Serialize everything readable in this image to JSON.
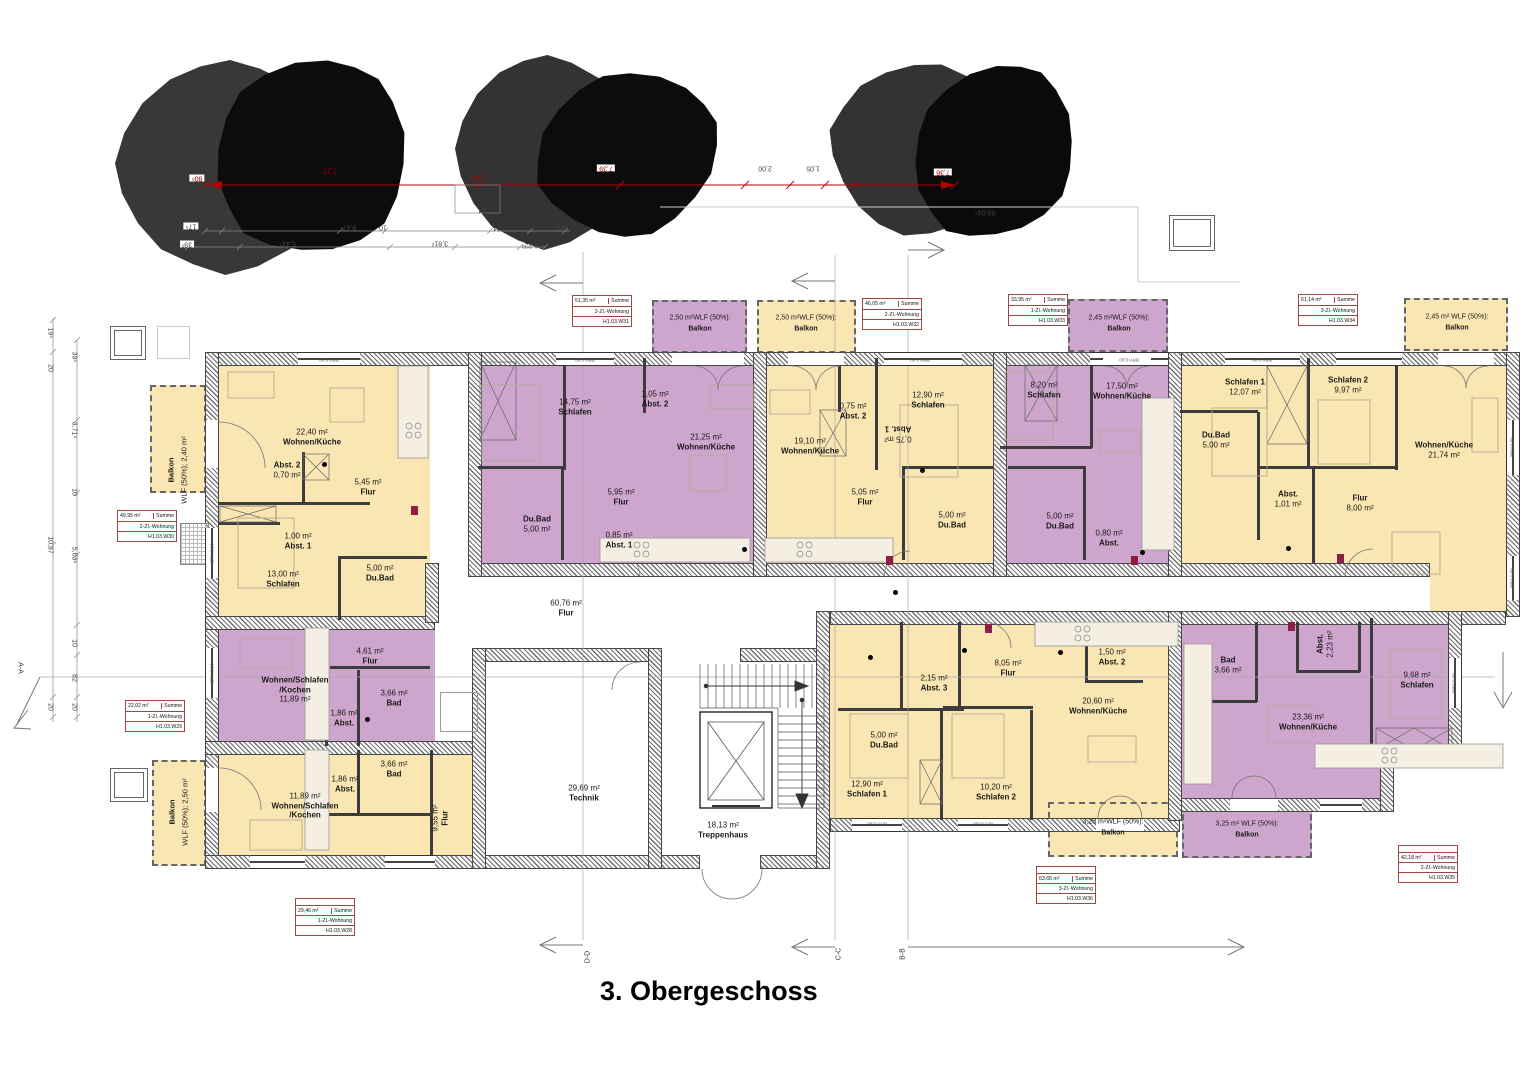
{
  "title": "3. Obergeschoss",
  "labels": {
    "summe": "Summe"
  },
  "window_label": "BRH 0,00",
  "colors": {
    "apartment_yellow": "#FAE6B2",
    "apartment_purple": "#CEA5CC",
    "info_border": "#A04444",
    "dim_red": "#B30000"
  },
  "sections": {
    "aa": "A-A",
    "bb": "B-B",
    "cc": "C-C",
    "dd": "D-D"
  },
  "apartments": {
    "w28": {
      "area": "29,46 m²",
      "type": "1-Zl.-Wohnung",
      "code": "H1.03.W28"
    },
    "w29": {
      "area": "22,02 m²",
      "type": "1-Zl.-Wohnung",
      "code": "H1.03.W29"
    },
    "w30": {
      "area": "49,95 m²",
      "type": "2-Zl.-Wohnung",
      "code": "H1.03.W30"
    },
    "w31": {
      "area": "51,35 m²",
      "type": "2-Zl.-Wohnung",
      "code": "H1.03.W31"
    },
    "w32": {
      "area": "46,05 m²",
      "type": "2-Zl.-Wohnung",
      "code": "H1.03.W32"
    },
    "w33": {
      "area": "33,95 m²",
      "type": "1-Zl.-Wohnung",
      "code": "H1.03.W33"
    },
    "w34": {
      "area": "61,14 m²",
      "type": "3-Zl.-Wohnung",
      "code": "H1.03.W34"
    },
    "w35": {
      "area": "42,18 m²",
      "type": "2-Zl.-Wohnung",
      "code": "H1.03.W35"
    },
    "w36": {
      "area": "63,65 m²",
      "type": "3-Zl.-Wohnung",
      "code": "H1.03.W36"
    }
  },
  "rooms": {
    "w30_wk": {
      "l1": "22,40 m²",
      "l2": "Wohnen/Küche"
    },
    "w30_abst2": {
      "l1": "Abst. 2",
      "l2": "0,70 m²"
    },
    "w30_flur": {
      "l1": "5,45 m²",
      "l2": "Flur"
    },
    "w30_abst1": {
      "l1": "1,00 m²",
      "l2": "Abst. 1"
    },
    "w30_schlafen": {
      "l1": "13,00 m²",
      "l2": "Schlafen"
    },
    "w30_dubad": {
      "l1": "5,00 m²",
      "l2": "Du.Bad"
    },
    "w31_schlafen": {
      "l1": "14,75 m²",
      "l2": "Schlafen"
    },
    "w31_abst2": {
      "l1": "1,05 m²",
      "l2": "Abst. 2"
    },
    "w31_wk": {
      "l1": "21,25 m²",
      "l2": "Wohnen/Küche"
    },
    "w31_dubad": {
      "l1": "Du.Bad",
      "l2": "5,00 m²"
    },
    "w31_flur": {
      "l1": "5,95 m²",
      "l2": "Flur"
    },
    "w31_abst1": {
      "l1": "0,85 m²",
      "l2": "Abst. 1"
    },
    "w32_wk": {
      "l1": "19,10 m²",
      "l2": "Wohnen/Küche"
    },
    "w32_abst2": {
      "l1": "0,75 m²",
      "l2": "Abst. 2"
    },
    "w32_schlafen": {
      "l1": "12,90 m²",
      "l2": "Schlafen"
    },
    "w32_abst1": {
      "l1": "0,75 m²",
      "l2": "Abst. 1"
    },
    "w32_flur": {
      "l1": "5,05 m²",
      "l2": "Flur"
    },
    "w32_dubad": {
      "l1": "5,00 m²",
      "l2": "Du.Bad"
    },
    "w33_schlafen": {
      "l1": "8,20 m²",
      "l2": "Schlafen"
    },
    "w33_wk": {
      "l1": "17,50 m²",
      "l2": "Wohnen/Küche"
    },
    "w33_dubad": {
      "l1": "5,00 m²",
      "l2": "Du.Bad"
    },
    "w33_abst": {
      "l1": "0,80 m²",
      "l2": "Abst."
    },
    "w34_schlafen1": {
      "l1": "Schlafen 1",
      "l2": "12,07 m²"
    },
    "w34_schlafen2": {
      "l1": "Schlafen 2",
      "l2": "9,97 m²"
    },
    "w34_dubad": {
      "l1": "Du.Bad",
      "l2": "5,00 m²"
    },
    "w34_abst": {
      "l1": "Abst.",
      "l2": "1,01 m²"
    },
    "w34_flur": {
      "l1": "Flur",
      "l2": "8,00 m²"
    },
    "w34_wk": {
      "l1": "Wohnen/Küche",
      "l2": "21,74 m²"
    },
    "w29_wsk": {
      "l1": "Wohnen/Schlafen",
      "l2": "/Kochen",
      "l3": "11,89 m²"
    },
    "w29_flur": {
      "l1": "4,61 m²",
      "l2": "Flur"
    },
    "w29_abst": {
      "l1": "1,86 m²",
      "l2": "Abst."
    },
    "w29_bad": {
      "l1": "3,66 m²",
      "l2": "Bad"
    },
    "w28_wsk": {
      "l1": "11,89 m²",
      "l2": "Wohnen/Schlafen",
      "l3": "/Kochen"
    },
    "w28_abst": {
      "l1": "1,86 m²",
      "l2": "Abst."
    },
    "w28_bad": {
      "l1": "3,66 m²",
      "l2": "Bad"
    },
    "w28_flur": {
      "l1": "9,55 m²",
      "l2": "Flur"
    },
    "w36_abst3": {
      "l1": "2,15 m²",
      "l2": "Abst. 3"
    },
    "w36_dubad": {
      "l1": "5,00 m²",
      "l2": "Du.Bad"
    },
    "w36_flur": {
      "l1": "8,05 m²",
      "l2": "Flur"
    },
    "w36_abst2": {
      "l1": "1,50 m²",
      "l2": "Abst. 2"
    },
    "w36_wk": {
      "l1": "20,60 m²",
      "l2": "Wohnen/Küche"
    },
    "w36_schlafen1": {
      "l1": "12,90 m²",
      "l2": "Schlafen 1"
    },
    "w36_schlafen2": {
      "l1": "10,20 m²",
      "l2": "Schlafen 2"
    },
    "w35_bad": {
      "l1": "Bad",
      "l2": "3,66 m²"
    },
    "w35_abst": {
      "l1": "Abst.",
      "l2": "2,23 m²"
    },
    "w35_schlafen": {
      "l1": "9,68 m²",
      "l2": "Schlafen"
    },
    "w35_wk": {
      "l1": "23,36 m²",
      "l2": "Wohnen/Küche"
    }
  },
  "common": {
    "flur": {
      "l1": "60,76 m²",
      "l2": "Flur"
    },
    "technik": {
      "l1": "29,69 m²",
      "l2": "Technik"
    },
    "trepp": {
      "l1": "18,13 m²",
      "l2": "Treppenhaus"
    }
  },
  "balconies": {
    "w30": {
      "name": "Balkon",
      "wlf": "WLF (50%); 2,40 m²"
    },
    "w28": {
      "name": "Balkon",
      "wlf": "WLF (50%); 2,50 m²"
    },
    "w31": {
      "wlf": "2,50 m²WLF (50%):",
      "name": "Balkon"
    },
    "w32": {
      "wlf": "2,50 m²WLF (50%):",
      "name": "Balkon"
    },
    "w33": {
      "wlf": "2,45 m²WLF (50%):",
      "name": "Balkon"
    },
    "w34": {
      "wlf": "2,45 m² WLF (50%):",
      "name": "Balkon"
    },
    "w36": {
      "wlf": "3,25 m²WLF (50%):",
      "name": "Balkon"
    },
    "w35": {
      "wlf": "3,25 m² WLF (50%):",
      "name": "Balkon"
    }
  },
  "dims": {
    "top_red": [
      "80⁵",
      "7,27",
      "1,87²",
      "7,39",
      "7,36"
    ],
    "top_gray": [
      "20",
      "17⁵",
      "39³",
      "8,47⁵",
      "10",
      "24",
      "24",
      "5,44³",
      "3,61²",
      "1,22²",
      "10",
      "2,00",
      "1,05",
      "50,04⁵"
    ],
    "left": [
      "19⁵",
      "20",
      "39⁵",
      "3,71⁴",
      "10",
      "10,37",
      "5,63⁶",
      "10",
      "82",
      "20",
      "20"
    ]
  }
}
